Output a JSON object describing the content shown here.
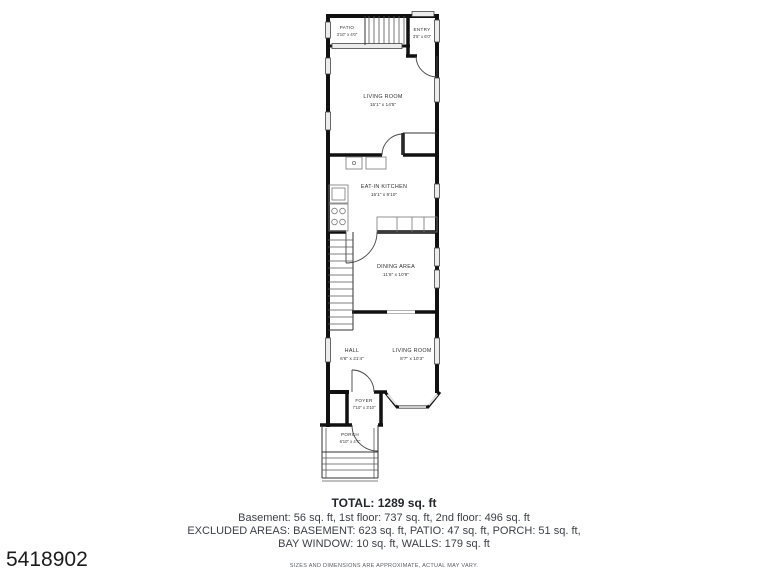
{
  "plan": {
    "rooms": {
      "patio": {
        "name": "PATIO",
        "dims": "3'10\" x 4'0\""
      },
      "entry": {
        "name": "ENTRY",
        "dims": "3'5\" x 6'0\""
      },
      "living_room_upper": {
        "name": "LIVING ROOM",
        "dims": "15'1\" x 14'5\""
      },
      "kitchen": {
        "name": "EAT-IN KITCHEN",
        "dims": "15'1\" x 9'10\""
      },
      "dining": {
        "name": "DINING AREA",
        "dims": "11'8\" x 10'9\""
      },
      "hall": {
        "name": "HALL",
        "dims": "6'6\" x 21'4\""
      },
      "living_room_lower": {
        "name": "LIVING ROOM",
        "dims": "8'7\" x 10'3\""
      },
      "foyer": {
        "name": "FOYER",
        "dims": "7'10\" x 3'10\""
      },
      "porch": {
        "name": "PORCH",
        "dims": "6'10\" x 4'4\""
      }
    }
  },
  "summary": {
    "total": "TOTAL: 1289 sq. ft",
    "floors_line": "Basement: 56 sq. ft, 1st floor: 737 sq. ft, 2nd floor: 496 sq. ft",
    "excluded_line1": "EXCLUDED AREAS: BASEMENT: 623 sq. ft, PATIO: 47 sq. ft, PORCH: 51 sq. ft,",
    "excluded_line2": "BAY WINDOW: 10 sq. ft, WALLS: 179 sq. ft",
    "disclaimer": "SIZES AND DIMENSIONS ARE APPROXIMATE, ACTUAL MAY VARY."
  },
  "listing_id": "5418902",
  "colors": {
    "wall": "#111111",
    "window_fill": "#ececec",
    "label_text": "#2e2e2e",
    "summary_text": "#3b3f46"
  }
}
